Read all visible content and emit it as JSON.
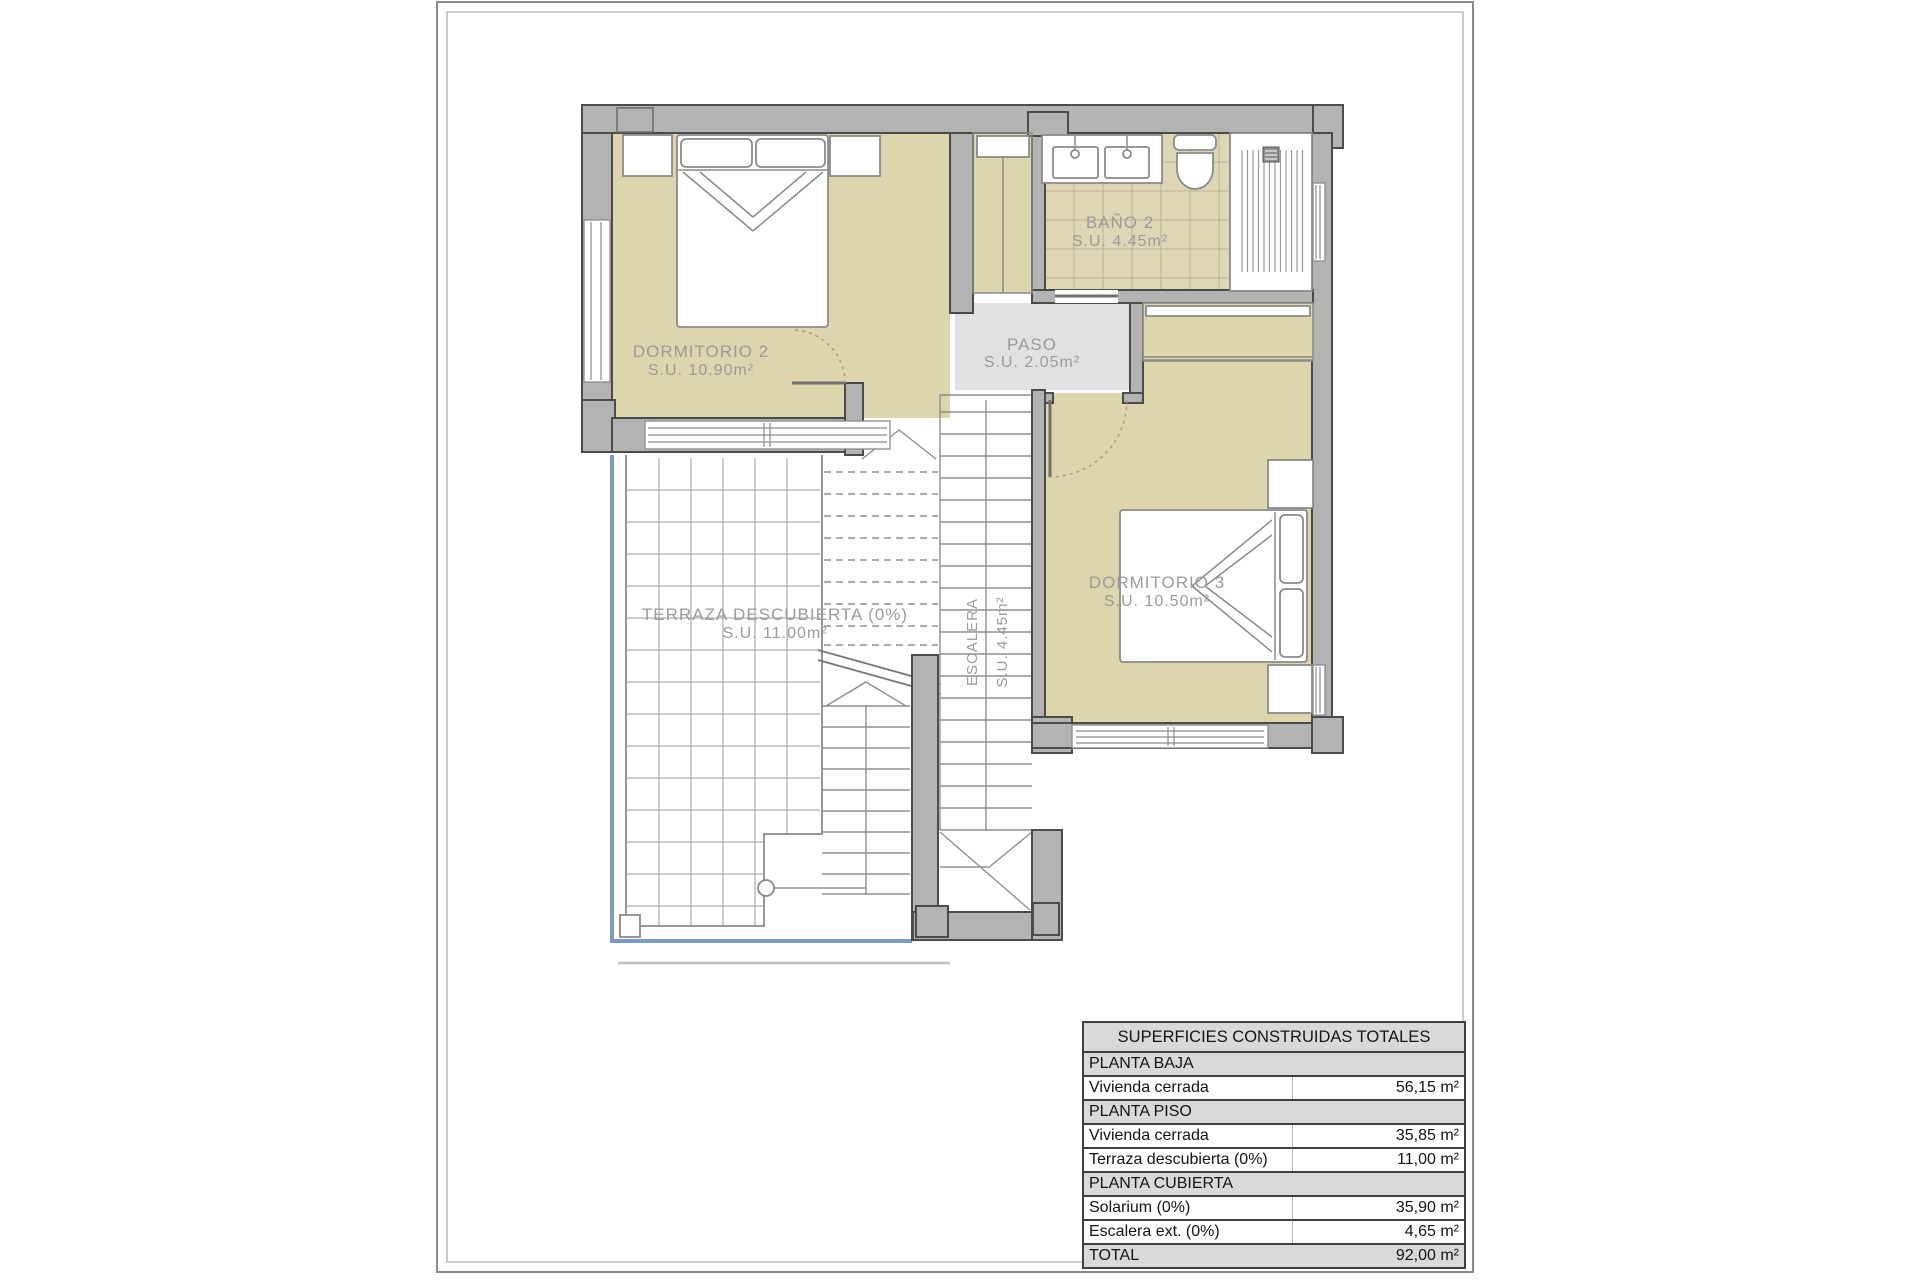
{
  "rooms": {
    "dormitorio2": {
      "name": "DORMITORIO 2",
      "area": "S.U. 10.90m²"
    },
    "bano2": {
      "name": "BAÑO 2",
      "area": "S.U. 4.45m²"
    },
    "paso": {
      "name": "PASO",
      "area": "S.U. 2.05m²"
    },
    "dormitorio3": {
      "name": "DORMITORIO 3",
      "area": "S.U. 10.50m²"
    },
    "escalera": {
      "name": "ESCALERA",
      "area": "S.U. 4.45m²"
    },
    "terraza": {
      "name": "TERRAZA DESCUBIERTA (0%)",
      "area": "S.U. 11.00m²"
    }
  },
  "table": {
    "title": "SUPERFICIES CONSTRUIDAS TOTALES",
    "rows": [
      {
        "label": "PLANTA BAJA",
        "value": "",
        "type": "section"
      },
      {
        "label": "Vivienda cerrada",
        "value": "56,15 m²",
        "type": "data"
      },
      {
        "label": "PLANTA PISO",
        "value": "",
        "type": "section"
      },
      {
        "label": "Vivienda cerrada",
        "value": "35,85 m²",
        "type": "data"
      },
      {
        "label": "Terraza descubierta (0%)",
        "value": "11,00 m²",
        "type": "data"
      },
      {
        "label": "PLANTA CUBIERTA",
        "value": "",
        "type": "section"
      },
      {
        "label": "Solarium (0%)",
        "value": "35,90 m²",
        "type": "data"
      },
      {
        "label": "Escalera ext. (0%)",
        "value": "4,65 m²",
        "type": "data"
      },
      {
        "label": "TOTAL",
        "value": "92,00 m²",
        "type": "total"
      }
    ]
  },
  "colors": {
    "room_fill": "#ddd5ab",
    "bath_fill": "#ded7b6",
    "paso_fill": "#e1e1e1",
    "wall_fill": "#b3b3b1",
    "wall_outline": "#4b4b4b",
    "terrace_rail": "#7b9cc2",
    "label_color": "#9b9b9b",
    "table_header_bg": "#d9d9d9",
    "table_border": "#3f3f3f"
  }
}
